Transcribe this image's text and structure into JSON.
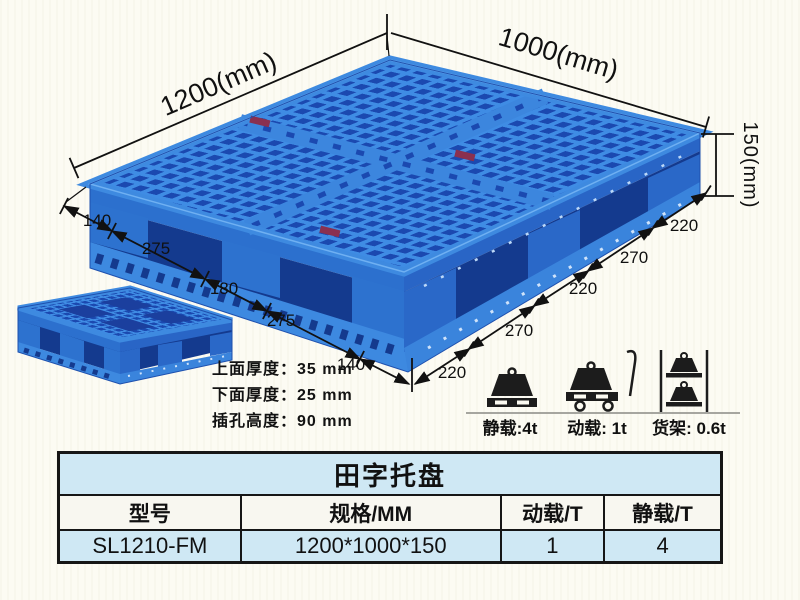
{
  "product": {
    "dims": {
      "top_left": "1200(mm)",
      "top_right": "1000(mm)",
      "height": "150(mm)",
      "left_edge": [
        "140",
        "275",
        "180",
        "275",
        "140"
      ],
      "right_edge": [
        "220",
        "270",
        "220",
        "270",
        "220"
      ]
    },
    "thickness": {
      "line1": "上面厚度：35 mm",
      "line2": "下面厚度：25 mm",
      "line3": "插孔高度：90 mm"
    },
    "loads": [
      {
        "icon": "static-load-icon",
        "label": "静载:4t"
      },
      {
        "icon": "dynamic-load-icon",
        "label": "动载: 1t"
      },
      {
        "icon": "rack-load-icon",
        "label": "货架: 0.6t"
      }
    ],
    "colors": {
      "pallet_rib": "#3f8ce4",
      "pallet_hole": "#1b49b0",
      "pallet_side": "#2c70ce",
      "pallet_shadow": "#143a8e",
      "background": "#fcfbf3",
      "table_blue": "#cfe8f4"
    }
  },
  "table": {
    "title": "田字托盘",
    "headers": [
      "型号",
      "规格/MM",
      "动载/T",
      "静载/T"
    ],
    "rows": [
      {
        "model": "SL1210-FM",
        "spec": "1200*1000*150",
        "dynamic_load": "1",
        "static_load": "4"
      }
    ]
  }
}
